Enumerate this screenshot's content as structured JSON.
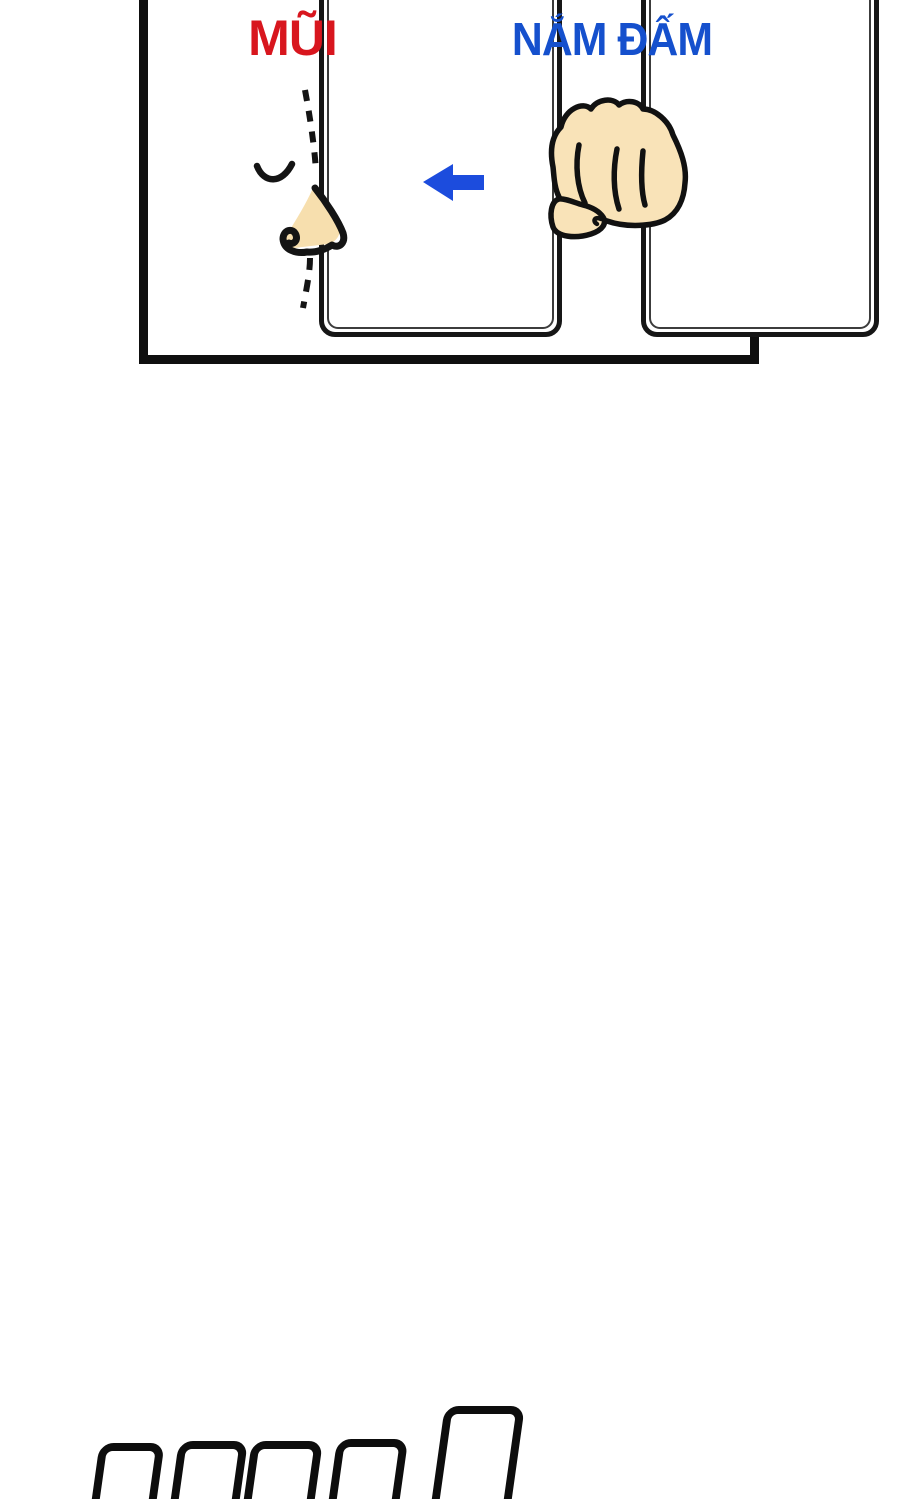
{
  "panel": {
    "cards": [
      {
        "id": "nose",
        "label": "MŨI",
        "label_color": "#d8161e",
        "illustration": "nose-profile"
      },
      {
        "id": "fist",
        "label": "NẮM ĐẤM",
        "label_color": "#1550cd",
        "illustration": "fist-punch"
      }
    ],
    "arrow": {
      "direction": "left",
      "color": "#1c4cdd"
    }
  },
  "colors": {
    "panel_border": "#0f0f0f",
    "card_border": "#161616",
    "line_art": "#141414",
    "nose_skin": "#f7dfae",
    "fist_skin": "#f9e3b8"
  },
  "bottom_shapes": {
    "kind": "sfx-rectangle-outlines",
    "count": 5,
    "color": "#0d0d0d"
  }
}
